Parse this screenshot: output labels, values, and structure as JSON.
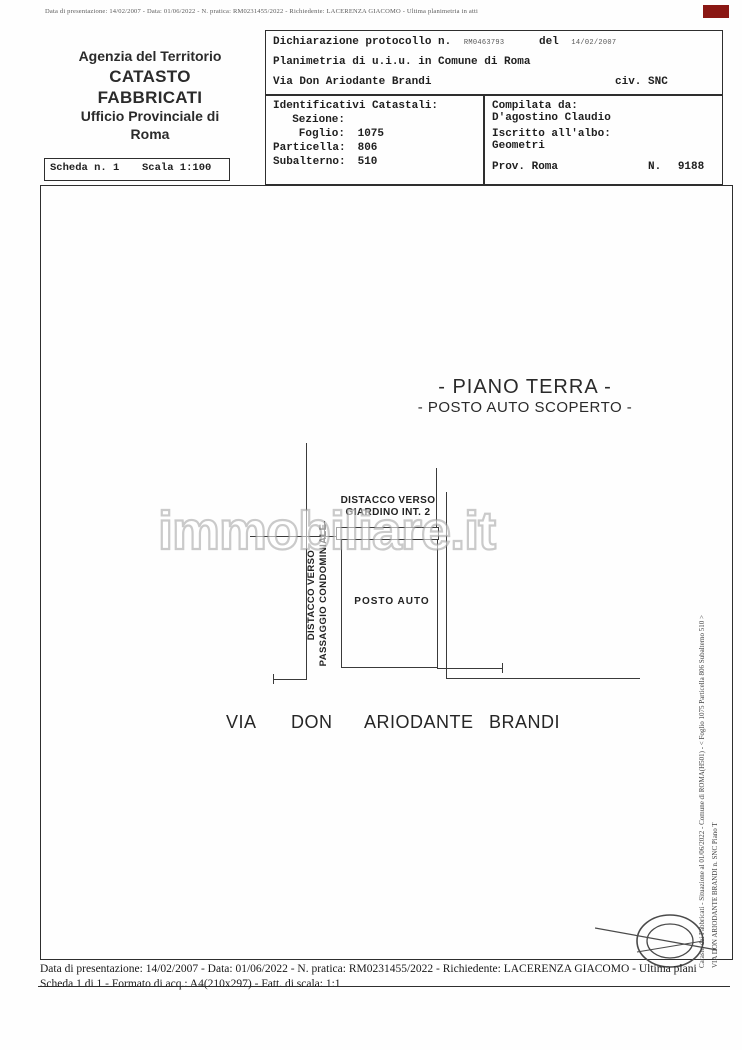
{
  "page": {
    "top_microprint": "Data di presentazione: 14/02/2007 - Data: 01/06/2022 - N. pratica: RM0231455/2022 - Richiedente: LACERENZA GIACOMO - Ultima planimetria in atti"
  },
  "agency": {
    "line1": "Agenzia del Territorio",
    "line2": "CATASTO FABBRICATI",
    "line3": "Ufficio Provinciale di",
    "line4": "Roma"
  },
  "declaration": {
    "label_protocol": "Dichiarazione protocollo n.",
    "protocol_number": "RM0463793",
    "label_del": "del",
    "protocol_date": "14/02/2007",
    "line2": "Planimetria di u.i.u. in Comune di Roma",
    "street": "Via Don Ariodante Brandi",
    "civic": "civ. SNC"
  },
  "identifiers": {
    "title": "Identificativi Catastali:",
    "sezione_label": "Sezione:",
    "sezione": "",
    "foglio_label": "Foglio:",
    "foglio": "1075",
    "particella_label": "Particella:",
    "particella": "806",
    "subalterno_label": "Subalterno:",
    "subalterno": "510"
  },
  "compiler": {
    "title": "Compilata da:",
    "name": "D'agostino Claudio",
    "register_label": "Iscritto all'albo:",
    "register": "Geometri",
    "prov_label": "Prov. Roma",
    "number_label": "N.",
    "number": "9188"
  },
  "scheda": {
    "label": "Scheda n. 1",
    "scale": "Scala 1:100"
  },
  "plan": {
    "title": "- PIANO TERRA -",
    "subtitle": "- POSTO AUTO SCOPERTO -",
    "label_giardino_1": "DISTACCO VERSO",
    "label_giardino_2": "GIARDINO INT. 2",
    "label_passaggio_1": "DISTACCO VERSO",
    "label_passaggio_2": "PASSAGGIO CONDOMINIALE",
    "room_label": "POSTO AUTO",
    "street_words": [
      "VIA",
      "DON",
      "ARIODANTE",
      "BRANDI"
    ]
  },
  "watermark": "immobiliare.it",
  "right_margin": {
    "outer": "Catasto dei Fabbricati - Situazione al 01/06/2022 - Comune di ROMA(H501) - < Foglio 1075 Particella 806 Subalterno 510 >",
    "inner": "VIA DON ARIODANTE BRANDI n. SNC Piano T"
  },
  "footer": {
    "line1": "Data di presentazione: 14/02/2007 - Data: 01/06/2022 - N. pratica: RM0231455/2022 - Richiedente: LACERENZA GIACOMO - Ultima plani",
    "line2": "Scheda 1 di 1 - Formato di acq.: A4(210x297) - Fatt. di scala: 1:1"
  }
}
